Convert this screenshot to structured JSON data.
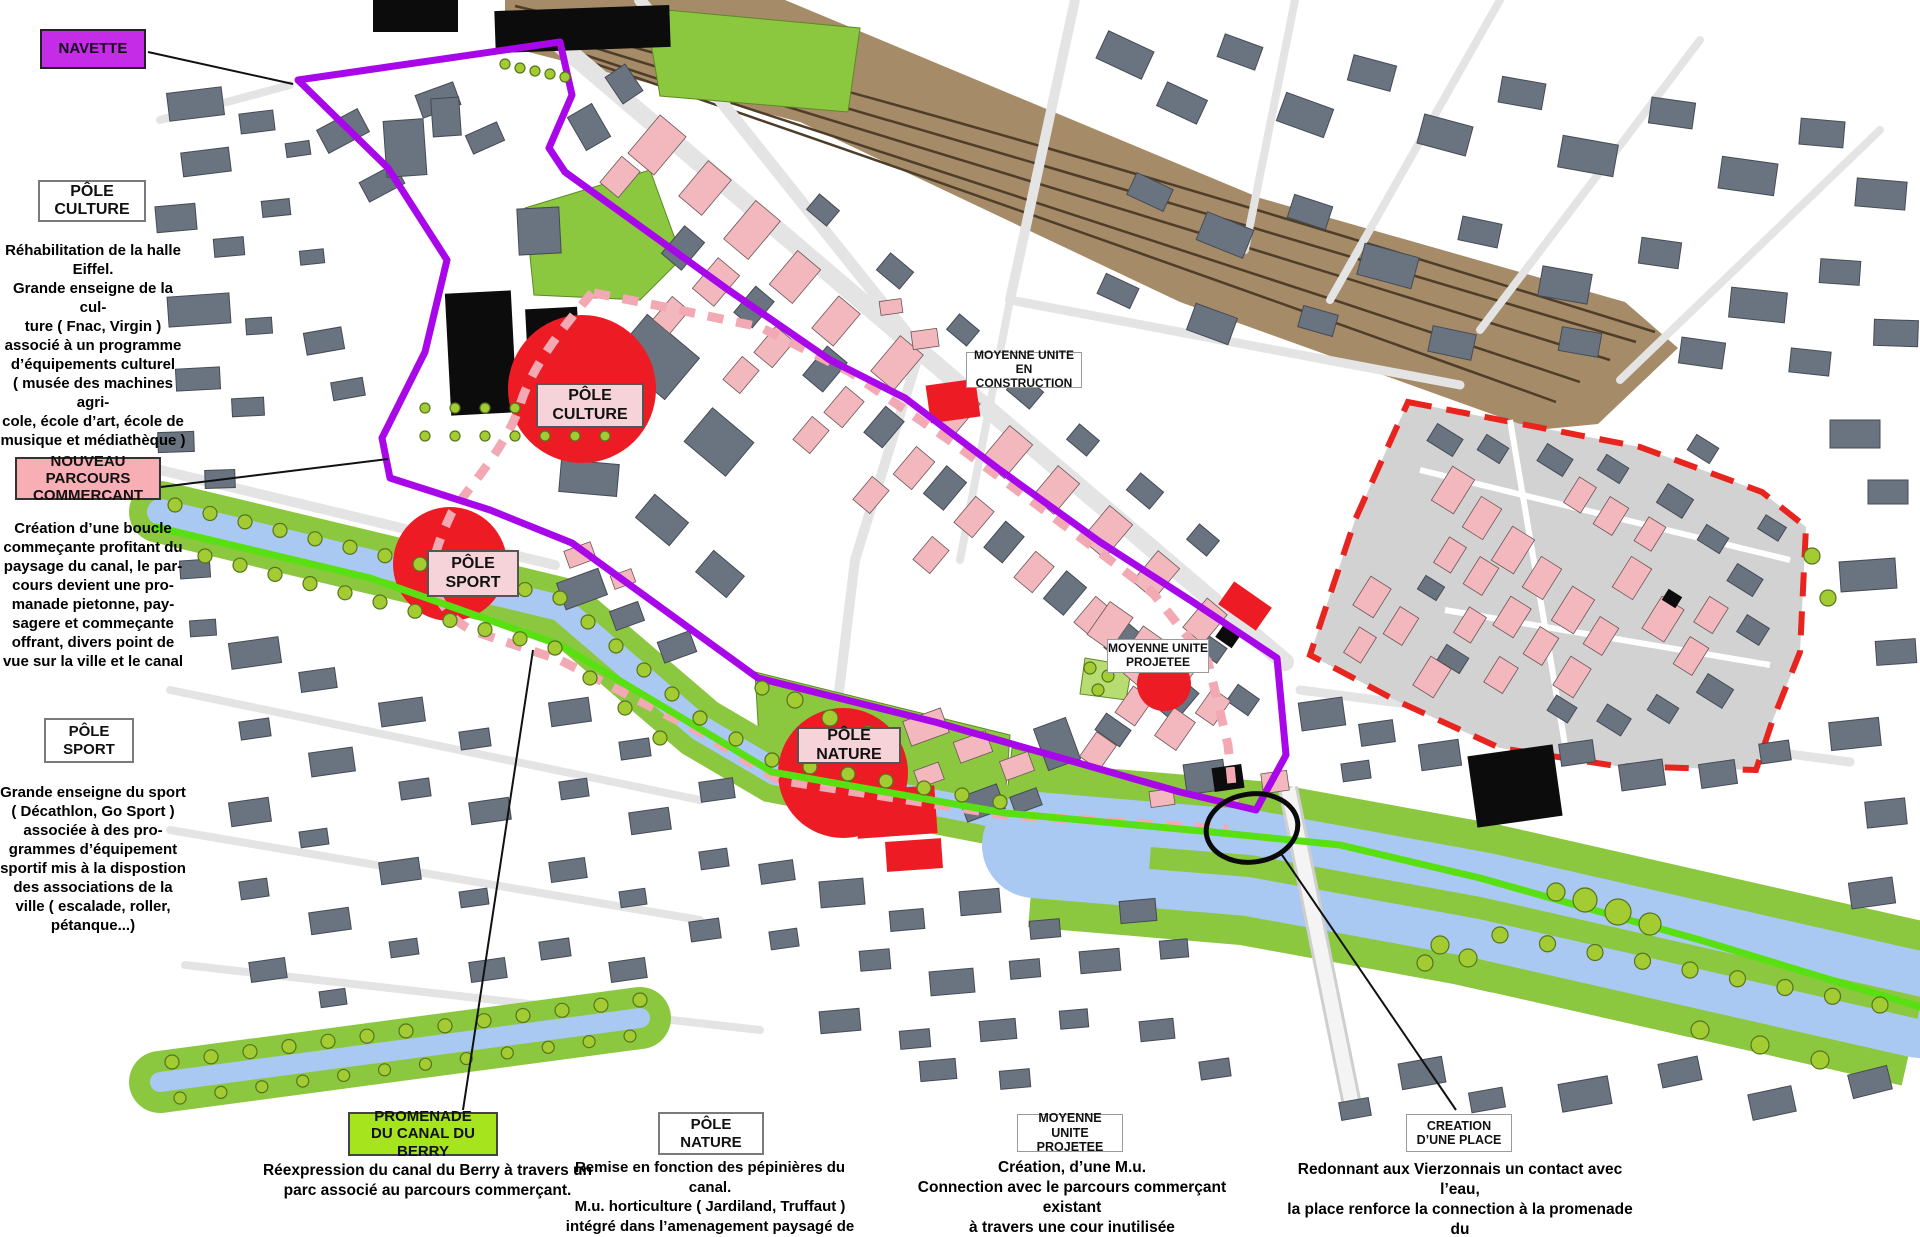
{
  "palette": {
    "navette_purple": "#c42ce8",
    "route_purple": "#a807e9",
    "commercant_pink": "#f7aeb5",
    "label_pink_light": "#f6d3d8",
    "promenade_green_label": "#a6e41d",
    "map_green": "#8cc740",
    "promenade_line_green": "#58e013",
    "water_blue": "#aac9f2",
    "rail_brown": "#a58b68",
    "building_grey": "#6a7380",
    "building_pink": "#f3b8bd",
    "accent_red": "#ed1c24",
    "zone_grey": "#d2d2d2"
  },
  "left_panel": {
    "navette_label": "NAVETTE",
    "pole_culture": {
      "label": "PÔLE CULTURE",
      "description": "Réhabilitation de la halle\nEiffel.\nGrande enseigne de la cul-\nture ( Fnac, Virgin )\nassocié à un programme\nd’équipements culturel\n( musée des machines agri-\ncole, école d’art, école de\nmusique et médiathèque )"
    },
    "nouveau_parcours": {
      "label": "NOUVEAU PARCOURS\nCOMMERCANT",
      "description": "Création d’une boucle\ncommeçante profitant du\npaysage du canal,  le par-\ncours devient une pro-\nmanade pietonne, pay-\nsagere et commeçante\noffrant, divers point de\nvue sur la ville et le canal"
    },
    "pole_sport": {
      "label": "PÔLE SPORT",
      "description": "Grande enseigne du sport\n( Décathlon, Go Sport )\nassociée à des pro-\ngrammes d’équipement\nsportif mis à la dispostion\ndes associations  de la\nville ( escalade, roller,\npétanque...)"
    }
  },
  "map_labels": {
    "pole_culture": "PÔLE CULTURE",
    "pole_sport": "PÔLE SPORT",
    "pole_nature": "PÔLE NATURE",
    "moyenne_unite_construction": "MOYENNE UNITE\nEN CONSTRUCTION",
    "moyenne_unite_projetee": "MOYENNE UNITE\nPROJETEE"
  },
  "bottom_panel": {
    "promenade": {
      "label": "PROMENADE\nDU CANAL DU BERRY",
      "description": "Réexpression du canal du Berry  à travers un\nparc  associé au parcours commerçant."
    },
    "pole_nature": {
      "label": "PÔLE NATURE",
      "description": "Remise en fonction des pépinières du canal.\nM.u.  horticulture  ( Jardiland,  Truffaut )\nintégré dans l’amenagement paysagé de\nla promenade du canal"
    },
    "moyenne_unite_projetee": {
      "label": "MOYENNE UNITE\nPROJETEE",
      "description": "Création, d’une  M.u.\nConnection avec le parcours commerçant existant\nà travers une cour inutilisée"
    },
    "creation_place": {
      "label": "CREATION\nD’UNE PLACE",
      "description": "Redonnant aux Vierzonnais un contact avec l’eau,\nla place renforce la connection à la promenade du\ncanal, rassemble les batiments administratif et\nconnecte les parcours commerçant."
    }
  }
}
